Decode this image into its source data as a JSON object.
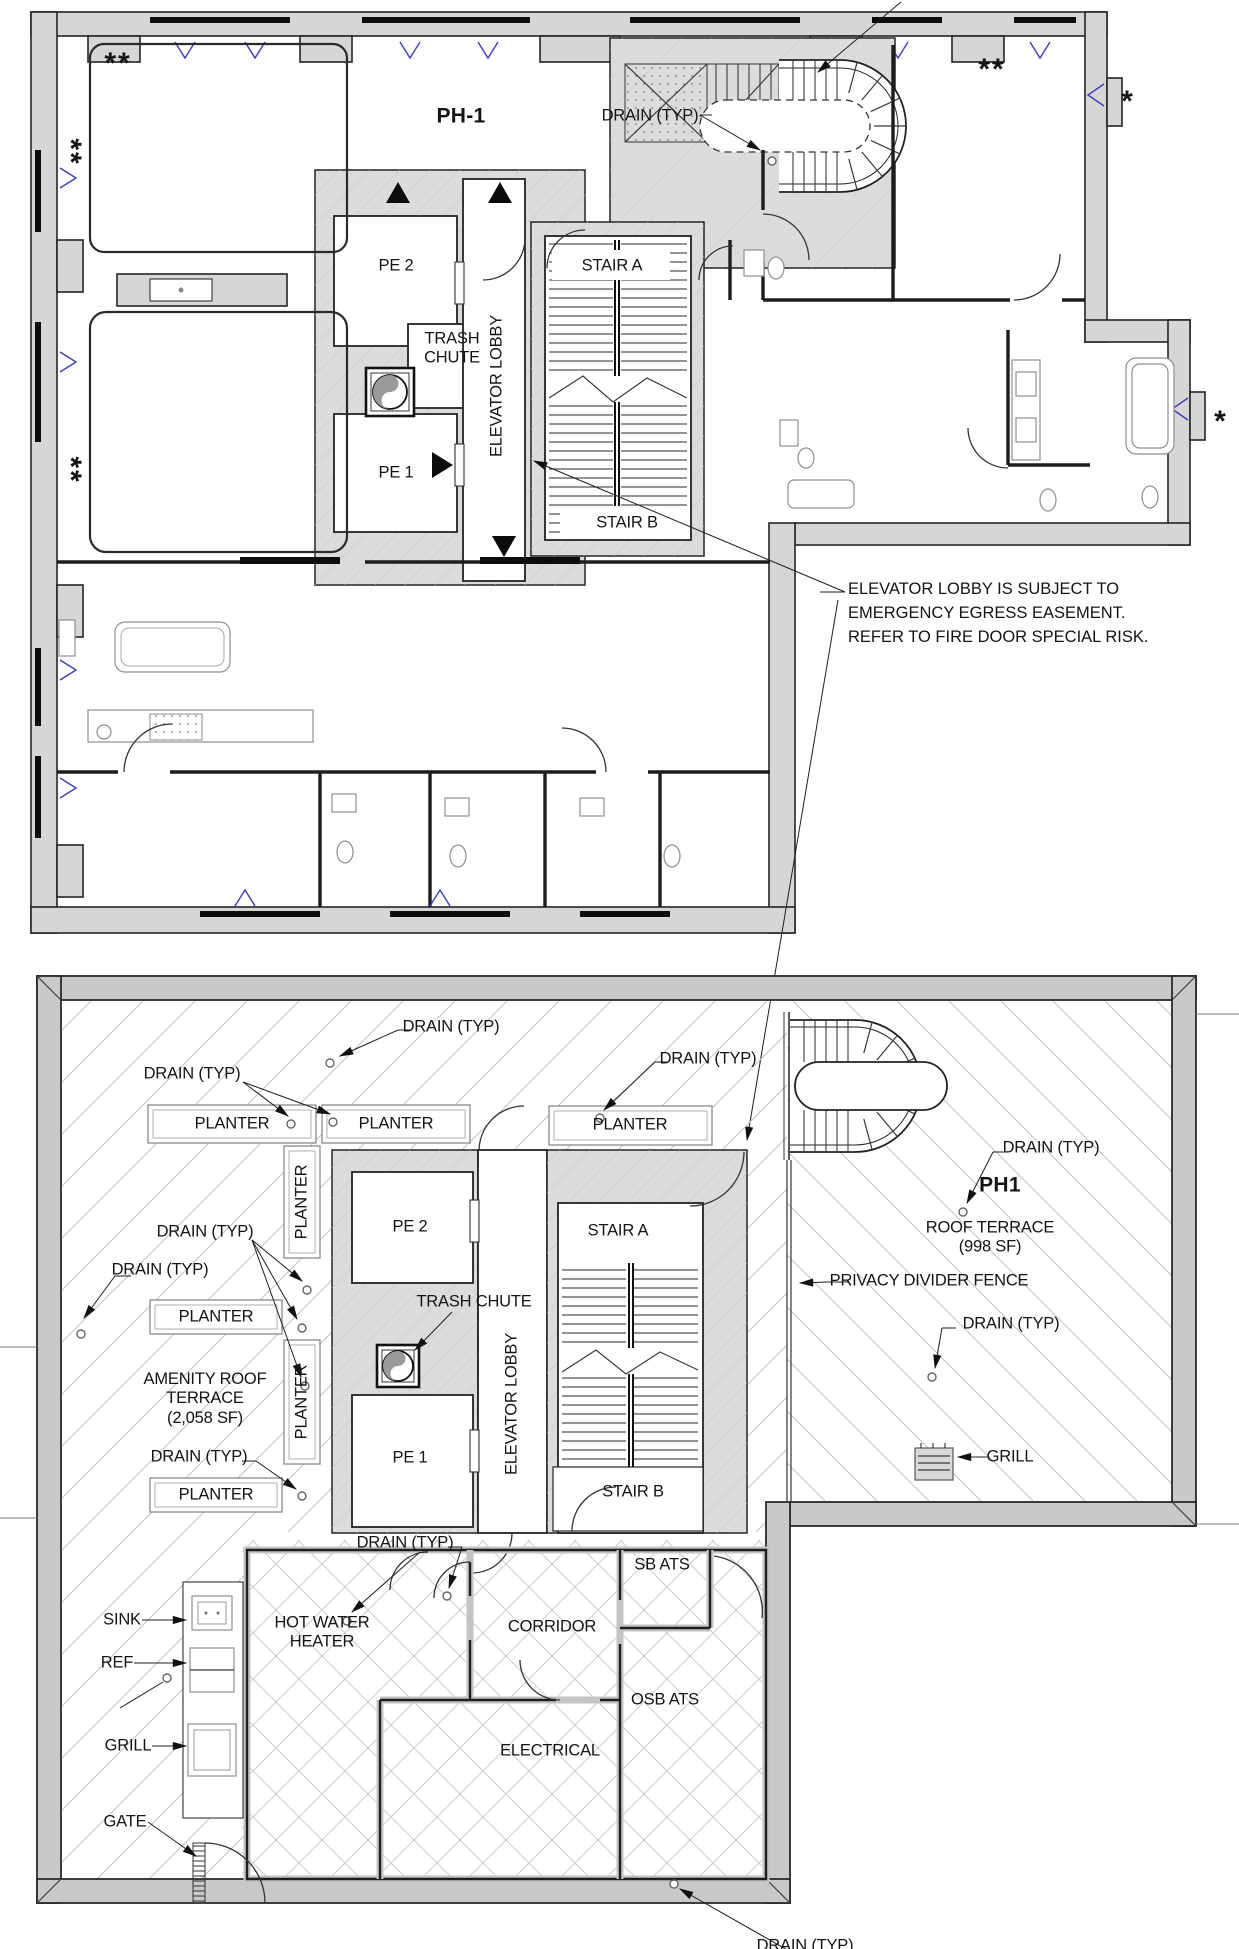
{
  "ph1_plan": {
    "title": "PH-1",
    "drain": "DRAIN (TYP)",
    "pe2": "PE 2",
    "pe1": "PE 1",
    "stair_a": "STAIR A",
    "stair_b": "STAIR B",
    "trash_line1": "TRASH",
    "trash_line2": "CHUTE",
    "elevator_lobby": "ELEVATOR LOBBY",
    "double_asterisk": "**",
    "asterisk": "*",
    "easement_note_line1": "ELEVATOR LOBBY IS SUBJECT TO",
    "easement_note_line2": "EMERGENCY EGRESS EASEMENT.",
    "easement_note_line3": "REFER TO FIRE DOOR SPECIAL RISK."
  },
  "roof_plan": {
    "drain": "DRAIN (TYP)",
    "planter": "PLANTER",
    "pe2": "PE 2",
    "pe1": "PE 1",
    "stair_a": "STAIR A",
    "stair_b": "STAIR B",
    "trash_chute": "TRASH CHUTE",
    "elevator_lobby": "ELEVATOR LOBBY",
    "unit_label": "PH1",
    "roof_terrace_line1": "ROOF TERRACE",
    "roof_terrace_line2": "(998 SF)",
    "privacy_divider_fence": "PRIVACY DIVIDER FENCE",
    "amenity_line1": "AMENITY ROOF",
    "amenity_line2": "TERRACE",
    "amenity_line3": "(2,058 SF)",
    "sink": "SINK",
    "ref": "REF",
    "grill": "GRILL",
    "gate": "GATE",
    "hot_water_line1": "HOT WATER",
    "hot_water_line2": "HEATER",
    "corridor": "CORRIDOR",
    "electrical": "ELECTRICAL",
    "sb_ats": "SB ATS",
    "osb_ats": "OSB ATS"
  },
  "colors": {
    "wall_poche": "#d6d6d6",
    "parapet_fill": "#c9c9c9",
    "core_fill": "#dcdcdc",
    "hatch_line": "#c4c4c4",
    "window_mark_blue": "#3c3cc0",
    "line_ink": "#1d1d1d"
  }
}
